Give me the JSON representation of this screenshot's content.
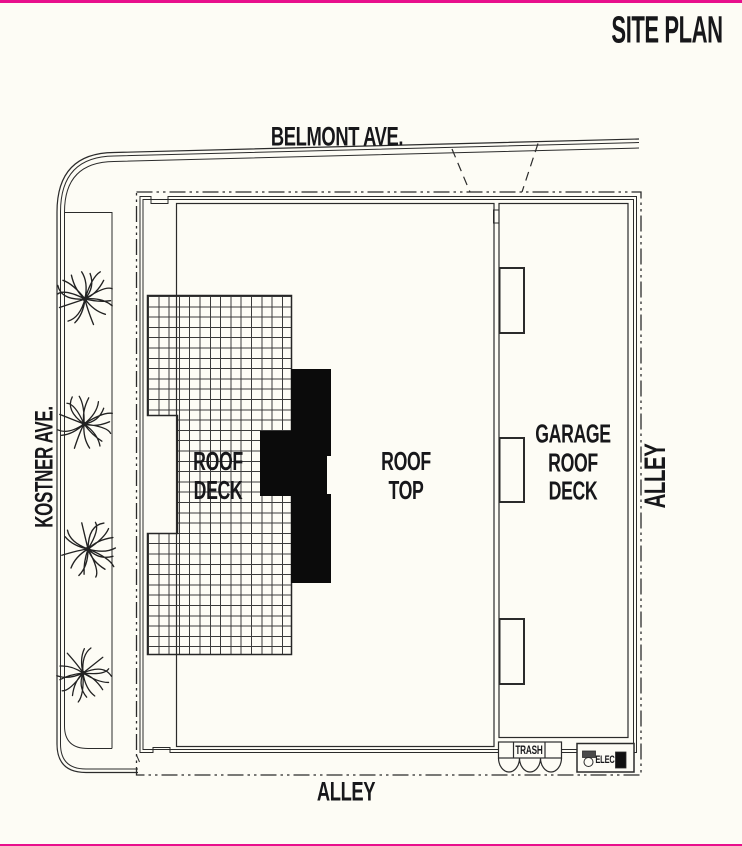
{
  "title": "SITE PLAN",
  "streets": {
    "north": "BELMONT AVE.",
    "west": "KOSTNER AVE.",
    "east": "ALLEY",
    "south": "ALLEY"
  },
  "areas": {
    "roof_deck": [
      "ROOF",
      "DECK"
    ],
    "roof_top": [
      "ROOF",
      "TOP"
    ],
    "garage_roof_deck": [
      "GARAGE",
      "ROOF",
      "DECK"
    ]
  },
  "equipment": {
    "trash": "TRASH",
    "elec": "ELEC"
  },
  "icons": {
    "tree": "tree-icon",
    "tree_count": 4
  },
  "colors": {
    "accent_pink": "#E8108C",
    "line": "#2b2b2b",
    "paper": "#FDFCF5",
    "core_fill": "#0b0b0b"
  }
}
